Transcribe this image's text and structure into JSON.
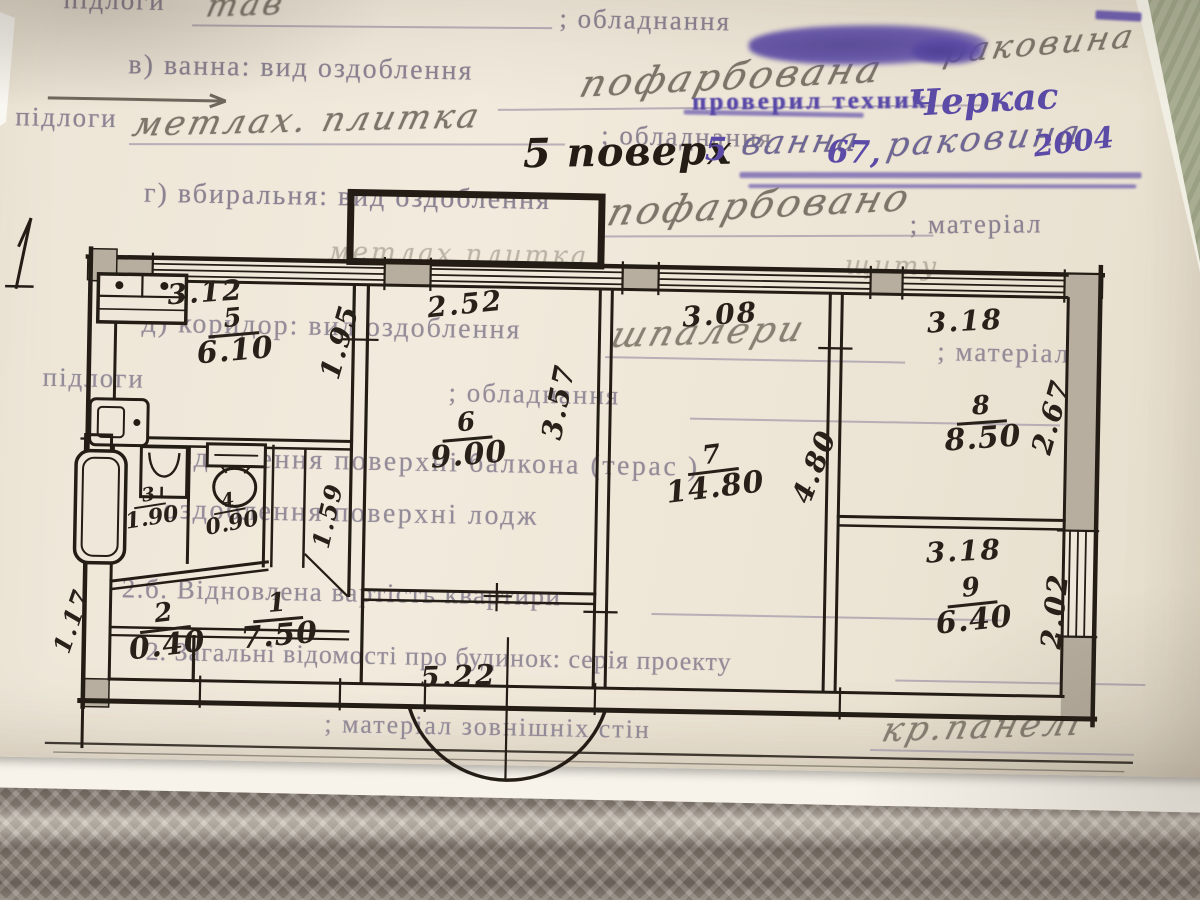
{
  "form": {
    "line1": {
      "label": "підлоги",
      "entry": "тав",
      "label2": "; обладнання",
      "entry2": "раковина"
    },
    "line2": {
      "label": "в) ванна:  вид оздоблення",
      "entry": "пофарбована"
    },
    "stamp": {
      "text": "проверил техник",
      "signature": "Черкас"
    },
    "line3": {
      "label": "підлоги",
      "entry": "метлах. плитка",
      "label2": "; обладнання",
      "floor_note": "5 поверх",
      "num": "5",
      "entry2": "ванна",
      "entry2_num": "67,",
      "entry3": "раковина",
      "year": "2004"
    },
    "line4": {
      "label": "г) вбиральня: вид оздоблення",
      "entry": "пофарбовано",
      "label2": "; матеріал"
    },
    "bg": {
      "top_fragment": "метлах плитка",
      "top_fragment2": "щиту",
      "corridor": {
        "label": "д) коридор: вид оздоблення",
        "entry": "шпалери",
        "label2": "; матеріал"
      },
      "floors2": {
        "label": "підлоги",
        "label2": "; обладнання"
      },
      "balcony": "оздоблення поверхні балкона (терас  )",
      "loggia": "оздоблення поверхні лодж",
      "restored": "2.б. Відновлена вартість квартири",
      "general": "2. Загальні відомості про будинок: серія проекту",
      "walls": {
        "label": "; матеріал зовнішніх стін",
        "entry": "кр.панелі"
      }
    }
  },
  "plan": {
    "rooms": [
      {
        "num": "5",
        "area": "6.10"
      },
      {
        "num": "6",
        "area": "9.00"
      },
      {
        "num": "7",
        "area": "14.80"
      },
      {
        "num": "8",
        "area": "8.50"
      },
      {
        "num": "9",
        "area": "6.40"
      },
      {
        "num": "3",
        "area": "1.90"
      },
      {
        "num": "4",
        "area": "0.90"
      },
      {
        "num": "2",
        "area": "0.40"
      },
      {
        "num": "1",
        "area": "7.50"
      }
    ],
    "dims": {
      "kitchen_top": "3.12",
      "room6_top": "2.52",
      "room7_top": "3.08",
      "room8_top": "3.18",
      "room9_top": "3.18",
      "bottom": "5.22",
      "kitchen_side": "1.95",
      "room6_side": "3.57",
      "room7_side": "4.80",
      "room8_side": "2.67",
      "room9_side": "2.02",
      "hall_side": "1.59",
      "left_side": "1.17"
    }
  },
  "colors": {
    "paper": "#efe8da",
    "ink": "#231d16",
    "pencil": "#7d7569",
    "print": "#8b8292",
    "purple": "#5b4aa6",
    "fabric": "#8a8177",
    "wall_fill": "#b7ae9f"
  }
}
